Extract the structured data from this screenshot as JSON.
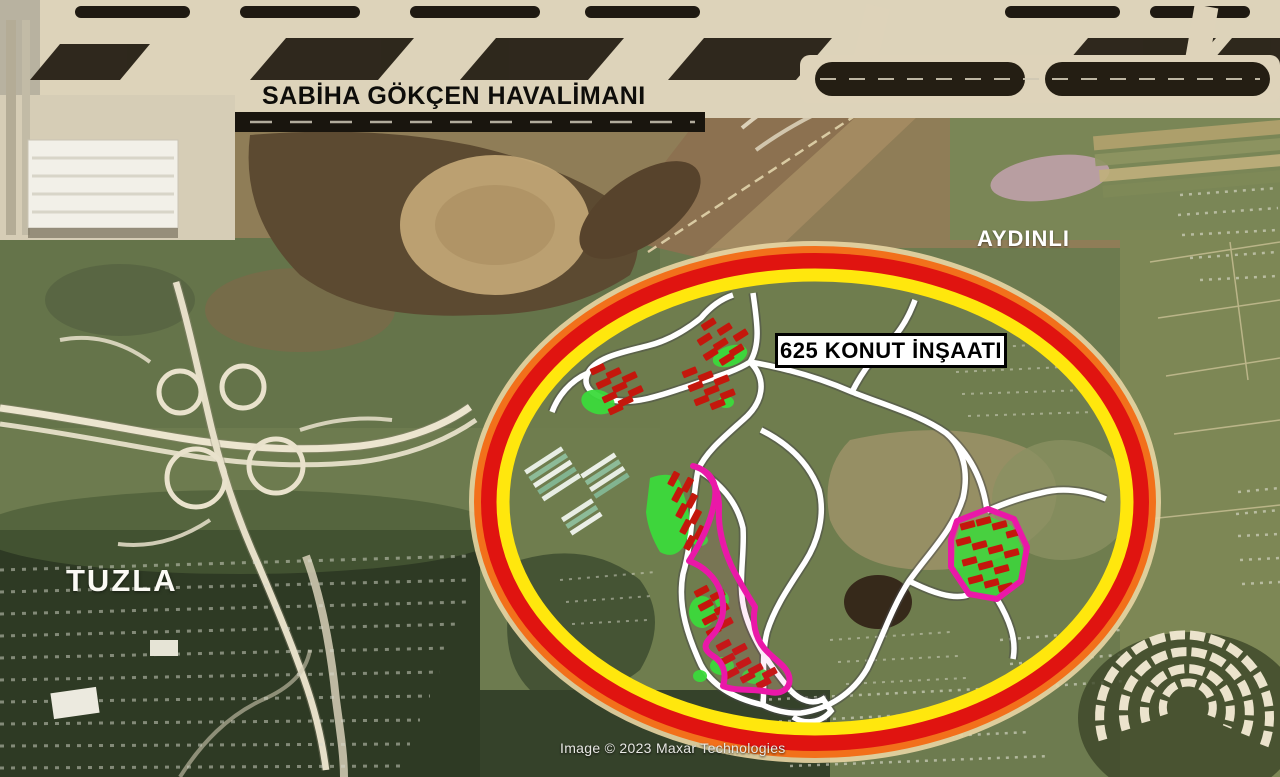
{
  "map": {
    "labels": {
      "airport": "SABİHA GÖKÇEN HAVALİMANI",
      "district_right": "AYDINLI",
      "district_left": "TUZLA"
    },
    "annotation": {
      "box_label": "625 KONUT İNŞAATI",
      "ellipse_halo": "#e9d6a4",
      "ellipse_orange": "#f2701b",
      "ellipse_red": "#e01410",
      "ellipse_yellow": "#ffe70d",
      "highlight_magenta": "#ea18a8",
      "building_red": "#c4170c",
      "green_bright": "#3bdb3b",
      "road_white": "#ffffff"
    },
    "attribution": "Image © 2023 Maxar Technologies"
  }
}
